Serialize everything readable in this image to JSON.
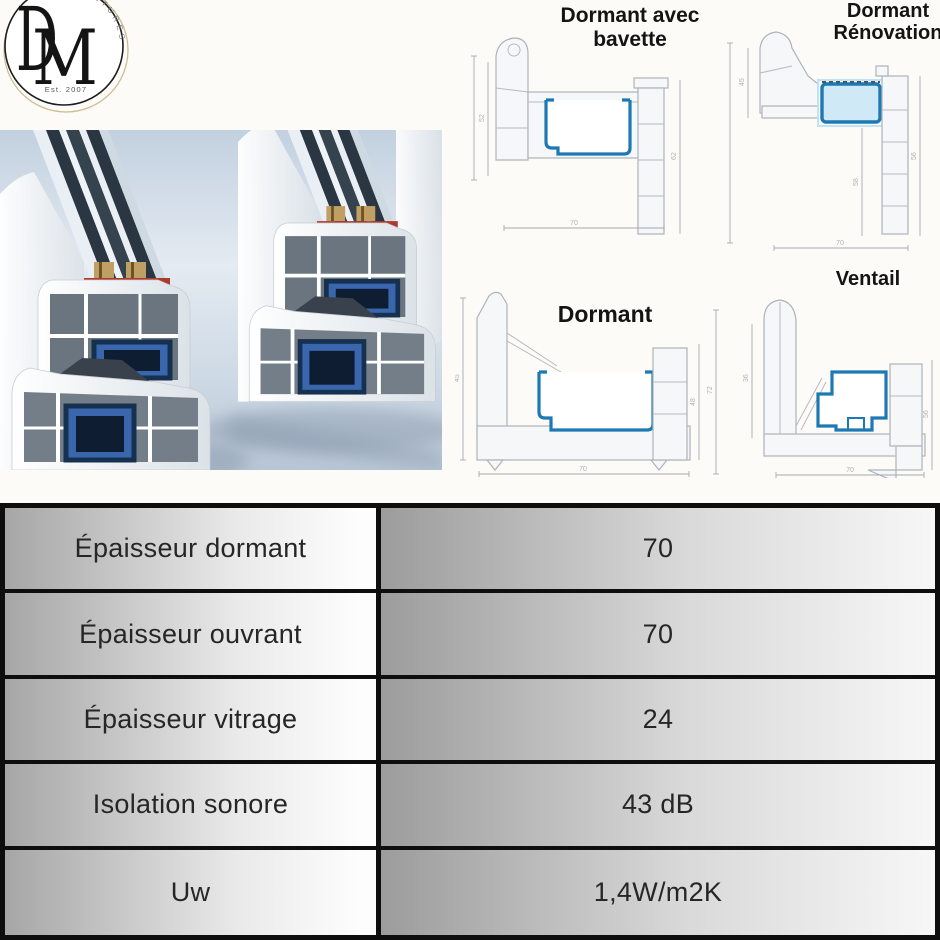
{
  "logo": {
    "d": "D",
    "m": "M",
    "arc_text": "ETURES",
    "established": "Est. 2007"
  },
  "diagrams": {
    "bavette": {
      "line1": "Dormant avec",
      "line2": "bavette",
      "dim_left": "52",
      "dim_bottom": "70",
      "dim_right": "62"
    },
    "renovation": {
      "line1": "Dormant",
      "line2": "Rénovation",
      "dim_left": "45",
      "dim_center": "58",
      "dim_right": "56",
      "dim_bottom": "70"
    },
    "dormant": {
      "label": "Dormant",
      "dim_left": "45",
      "dim_right": "48",
      "dim_bottom": "70"
    },
    "ventail": {
      "label": "Ventail",
      "dim_left": "72",
      "dim_inner": "36",
      "dim_right": "56",
      "dim_bottom": "70"
    }
  },
  "table": {
    "rows": [
      {
        "label": "Épaisseur dormant",
        "value": "70"
      },
      {
        "label": "Épaisseur ouvrant",
        "value": "70"
      },
      {
        "label": "Épaisseur vitrage",
        "value": "24"
      },
      {
        "label": "Isolation sonore",
        "value": "43 dB"
      },
      {
        "label": "Uw",
        "value": "1,4W/m2K"
      }
    ]
  },
  "colors": {
    "table_border": "#0e0e0e",
    "steel_outline_blue": "#1d79b4",
    "photo_sky": "#c6d4e2",
    "steel_fill_blue": "#3a66ad",
    "gasket_red": "#ad3a2c",
    "logo_gold_ring": "#cbbc90"
  }
}
